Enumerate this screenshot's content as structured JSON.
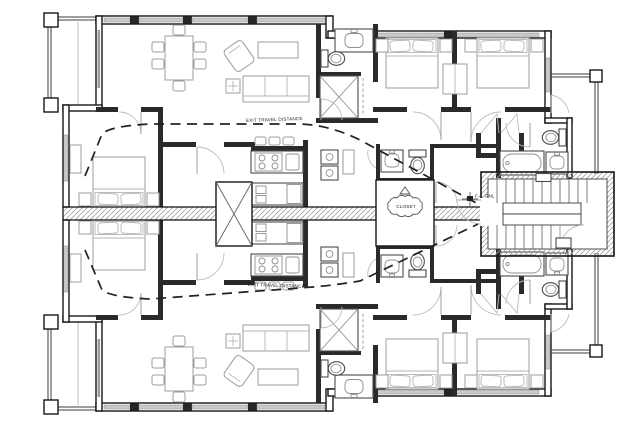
{
  "document": {
    "kind": "architectural floor plan",
    "description": "Mirrored multi-unit residential level plan with central stair core, kitchens, baths, bedrooms, decks and balconies"
  },
  "annotations": {
    "exit_path_top_label": "EXIT TRAVEL DISTANCE",
    "exit_path_bottom_label": "EXIT TRAVEL DISTANCE",
    "revision_cloud_note": "CLOSET",
    "fire_panel_label": "F.A. PNL"
  },
  "colors": {
    "wall": "#161616",
    "window_fill": "#c9c9c9",
    "furniture_line": "#9c9c9c",
    "fixture_line": "#4a4a4a",
    "egress_dashed_line": "#222222",
    "background": "#ffffff"
  },
  "elements": {
    "icons": [
      "bed-icon",
      "pillow-icon",
      "nightstand-icon",
      "dresser-icon",
      "wardrobe-icon",
      "dining-table-icon",
      "chair-icon",
      "sofa-icon",
      "armchair-icon",
      "coffee-table-icon",
      "side-table-icon",
      "bar-stool-icon",
      "range-icon",
      "kitchen-sink-icon",
      "refrigerator-icon",
      "toilet-icon",
      "bathtub-icon",
      "vanity-sink-icon",
      "washer-dryer-icon",
      "shaft-x-icon",
      "stair-treads-icon",
      "stair-landing-icon",
      "door-swing-icon",
      "deck-rail-icon",
      "balcony-rail-icon",
      "revision-cloud-icon",
      "revision-delta-icon",
      "window-icon",
      "fire-panel-icon"
    ]
  }
}
